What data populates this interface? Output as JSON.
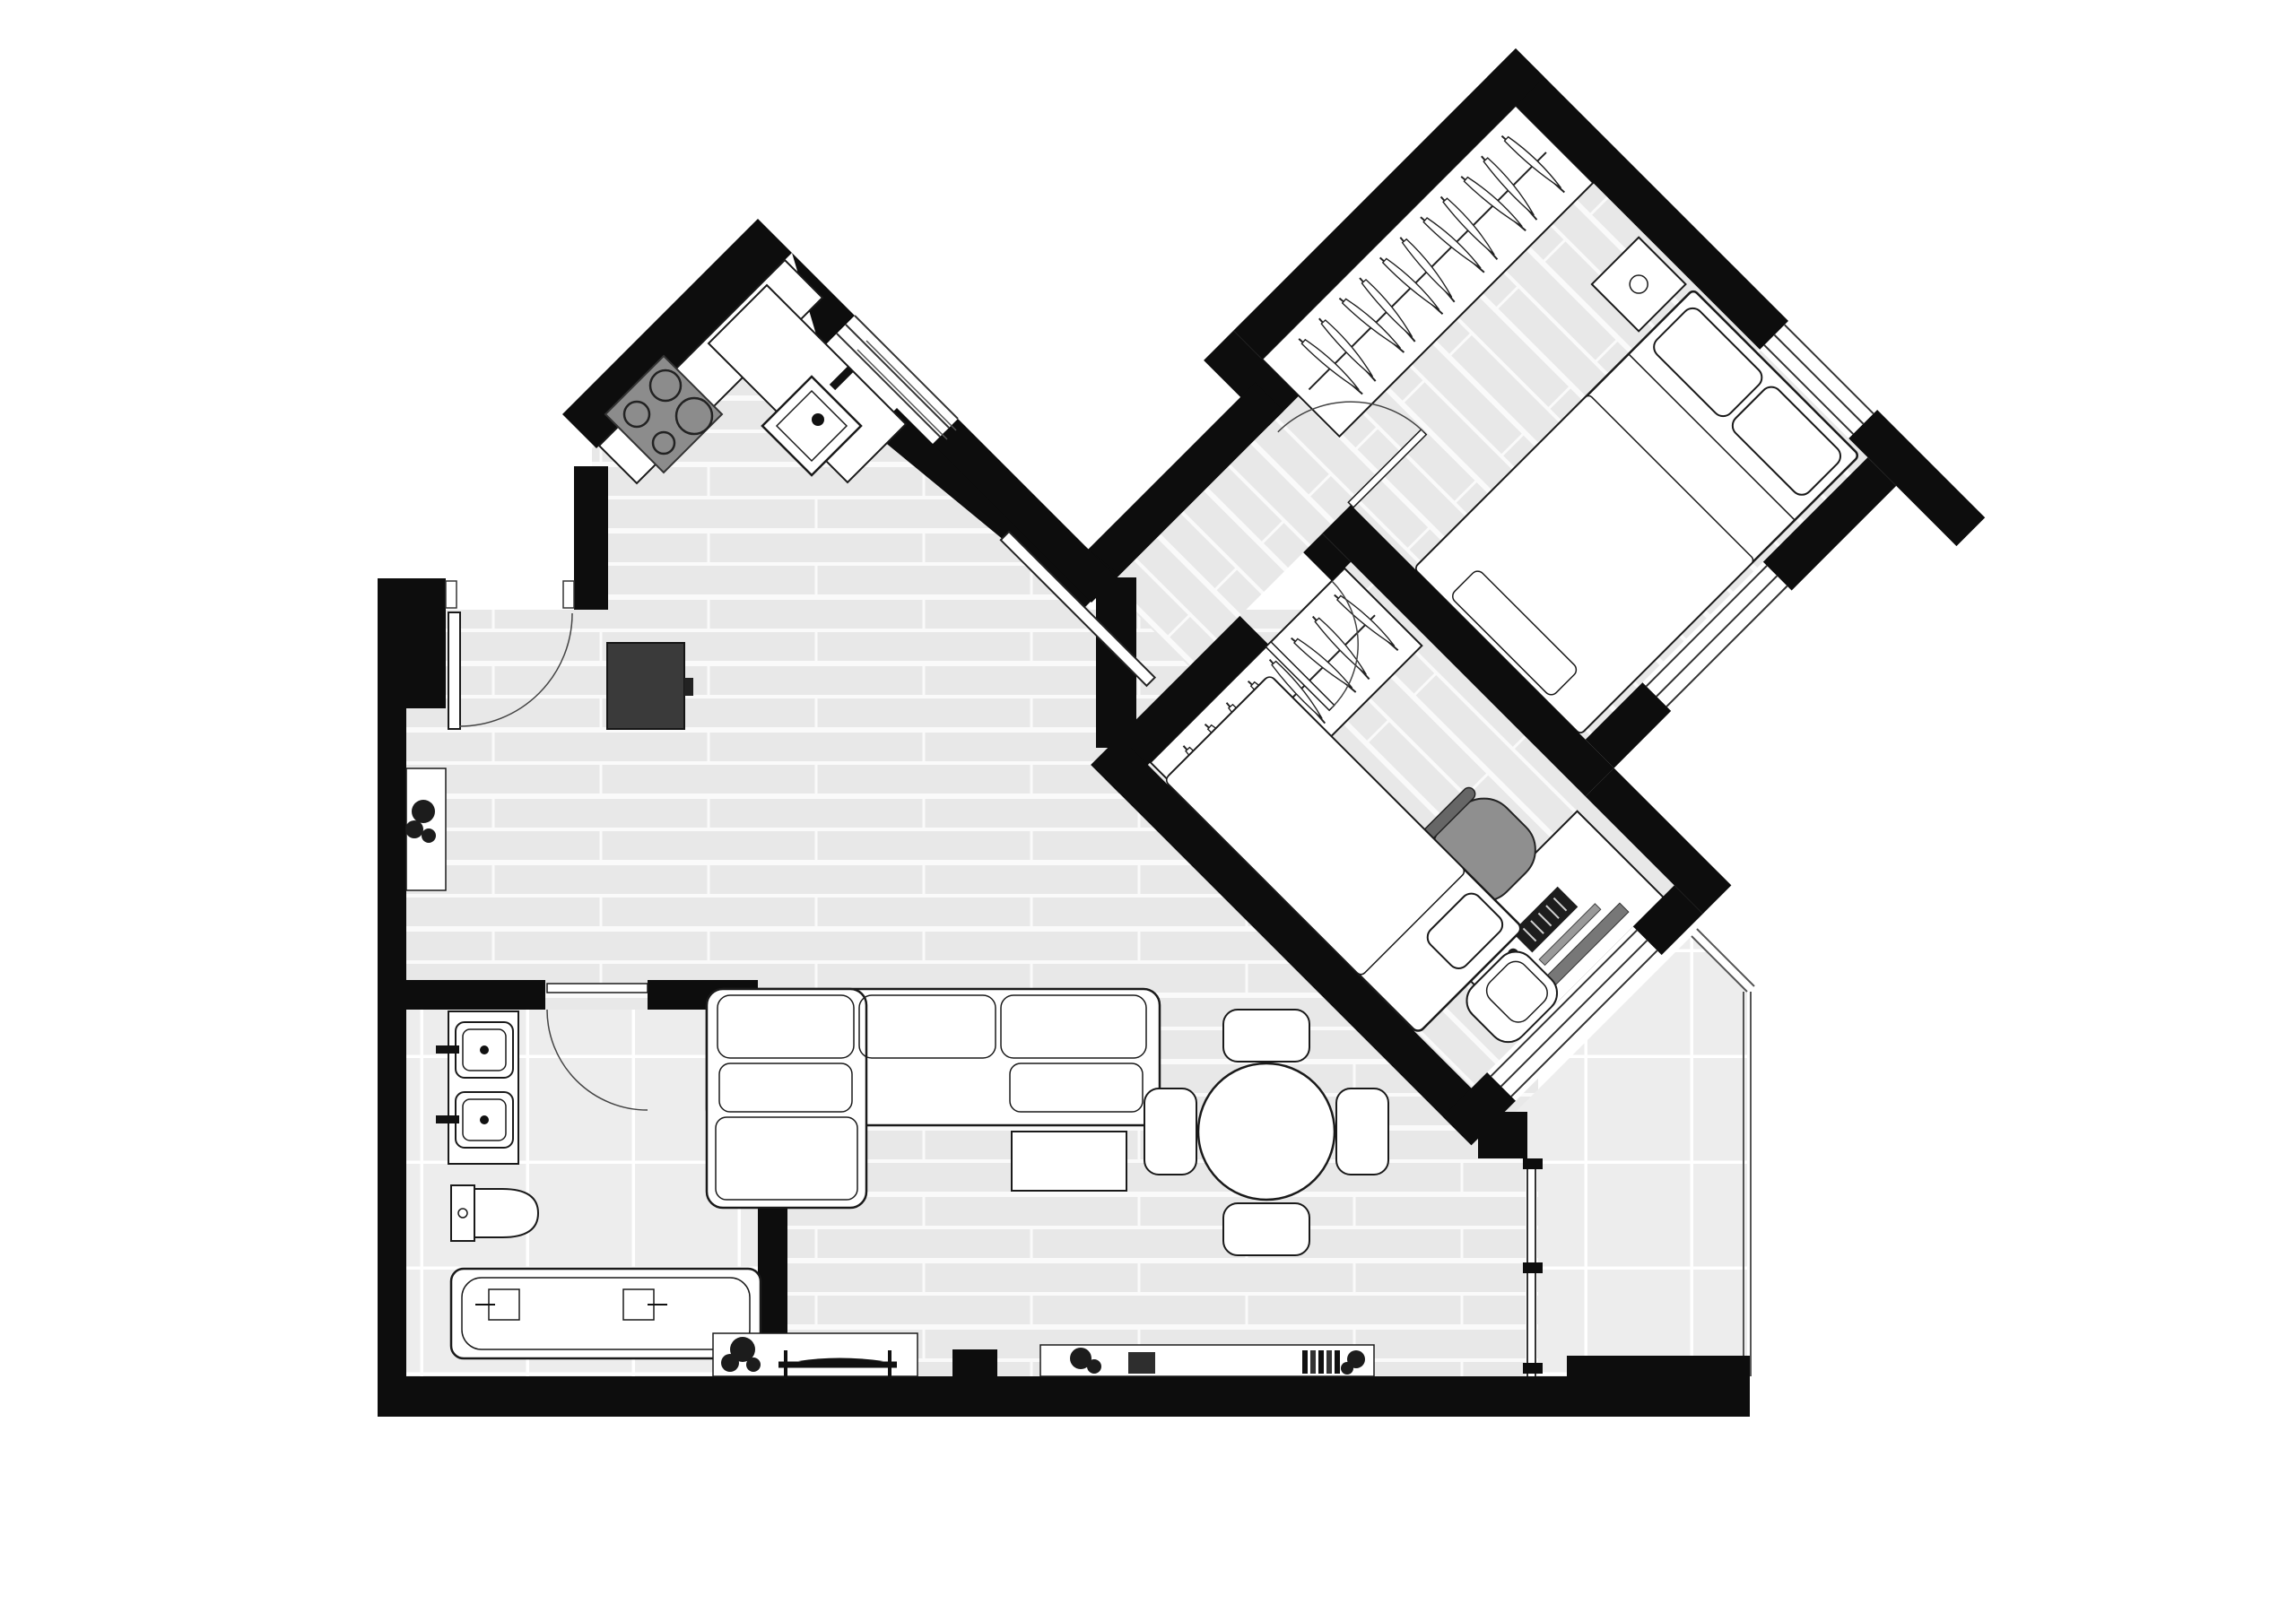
{
  "document": {
    "kind": "apartment floor plan",
    "style": "black and white architectural drawing, top-down view",
    "text_labels": [],
    "wing_rotation_degrees": 45
  },
  "colors": {
    "wall": "#0d0d0d",
    "background": "#ffffff",
    "wood_floor": "#e8e8e8",
    "floor_joint": "#fafafa",
    "tile_floor": "#ededed",
    "furniture_fill": "#ffffff",
    "furniture_line": "#1a1a1a",
    "cooktop_gray": "#8c8c8c",
    "tall_cabinet_gray": "#3a3a3a",
    "chair_gray": "#8f8f8f",
    "plant_dark": "#1c1c1c"
  },
  "rooms": [
    {
      "name": "entry hall",
      "floor": "wood planks",
      "features": [
        "entrance door with swing arc",
        "wall console with plant"
      ]
    },
    {
      "name": "kitchen",
      "floor": "wood planks",
      "features": [
        "L-shaped corner counter set diagonally",
        "cooktop with 4 burners",
        "sink with faucet",
        "tall dark cabinet fridge",
        "window in diagonal wall",
        "sliding door to bedroom hallway"
      ]
    },
    {
      "name": "living room",
      "floor": "wood planks",
      "features": [
        "L-shaped sectional sofa with cushions and two pillows",
        "coffee table",
        "TV sideboard with television and plant",
        "second sideboard with books, box and plants",
        "round dining table with four chairs",
        "glass partition to balcony"
      ]
    },
    {
      "name": "bathroom",
      "floor": "square tiles",
      "features": [
        "double vanity with two square basins and faucets",
        "toilet with cistern",
        "bathtub with two fixtures",
        "door with swing arc"
      ]
    },
    {
      "name": "bedroom (rotated wing)",
      "floor": "wood planks",
      "features": [
        "open wardrobe with clothes rail and hangers",
        "double bed with two pillows",
        "nightstand",
        "bench at foot of bed",
        "window to balcony side",
        "window in outer wall",
        "door with swing arc"
      ]
    },
    {
      "name": "office / second bedroom (rotated wing)",
      "floor": "wood planks",
      "features": [
        "open wardrobe with clothes rail and hangers",
        "desk with monitor, keyboard and mouse",
        "office chair",
        "single bed with pillow",
        "armchair",
        "long window",
        "door with swing arc"
      ]
    },
    {
      "name": "balcony",
      "floor": "large square tiles",
      "features": [
        "thin railing line",
        "glass partition with mullion ticks"
      ]
    }
  ],
  "counts": {
    "door_arcs": 4,
    "sliding_doors": 1,
    "windows": 4,
    "hangers_bedroom": 11,
    "hangers_office": 8,
    "dining_chairs": 4,
    "sinks_bathroom": 2,
    "burners": 4
  }
}
